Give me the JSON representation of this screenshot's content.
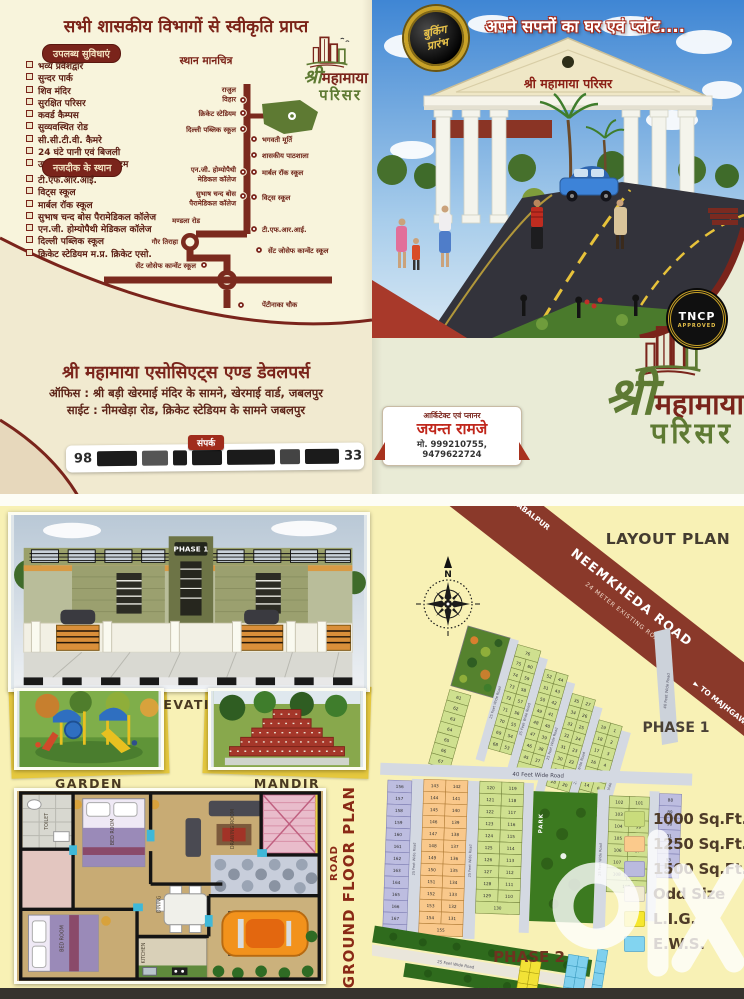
{
  "back": {
    "title": "सभी शासकीय विभागों से स्वीकृति प्राप्त",
    "facilities": {
      "heading": "उपलब्ध सुविधाएं",
      "items": [
        "भव्य प्रवेशद्वार",
        "सुन्दर पार्क",
        "शिव मंदिर",
        "सुरक्षित परिसर",
        "कवर्ड कैम्पस",
        "सुव्यवस्थित रोड",
        "सी.सी.टी.वी. कैमरे",
        "24 घंटे पानी एवं बिजली",
        "उच्च तकनीकी ड्रेनेज सिस्टम"
      ]
    },
    "nearby": {
      "heading": "नजदीक के स्थान",
      "items": [
        "टी.एफ.आर.आई.",
        "विट्स स्कूल",
        "मार्बल रॉक स्कूल",
        "सुभाष चन्द बोस पैरामेडिकल कॉलेज",
        "एन.जी. होम्योपैथी मेडिकल कॉलेज",
        "दिल्ली पब्लिक स्कूल",
        "क्रिकेट स्टेडियम म.प्र. क्रिकेट एसो."
      ]
    },
    "map": {
      "heading": "स्थान मानचित्र",
      "labels": [
        {
          "side": "L",
          "x": 236,
          "y": 16,
          "dot": [
            243,
            24
          ],
          "lines": [
            "राजुल",
            "विहार"
          ]
        },
        {
          "side": "L",
          "x": 236,
          "y": 40,
          "dot": [
            243,
            37
          ],
          "lines": [
            "क्रिकेट स्टेडियम"
          ]
        },
        {
          "side": "L",
          "x": 236,
          "y": 56,
          "dot": [
            243,
            53
          ],
          "lines": [
            "दिल्ली पब्लिक स्कूल"
          ]
        },
        {
          "side": "R",
          "x": 262,
          "y": 66,
          "dot": [
            254,
            63
          ],
          "lines": [
            "भगवती मूर्ति"
          ]
        },
        {
          "side": "R",
          "x": 262,
          "y": 82,
          "dot": [
            254,
            79
          ],
          "lines": [
            "शासकीय पाठशाला"
          ]
        },
        {
          "side": "L",
          "x": 236,
          "y": 96,
          "dot": [
            243,
            96
          ],
          "lines": [
            "एन.जी. होम्योपैथी",
            "मेडिकल कॉलेज"
          ]
        },
        {
          "side": "R",
          "x": 262,
          "y": 99,
          "dot": [
            254,
            96
          ],
          "lines": [
            "मार्बल रॉक स्कूल"
          ]
        },
        {
          "side": "L",
          "x": 236,
          "y": 120,
          "dot": [
            243,
            120
          ],
          "lines": [
            "सुभाष चन्द बोस",
            "पैरामेडिकल कॉलेज"
          ]
        },
        {
          "side": "R",
          "x": 262,
          "y": 124,
          "dot": [
            254,
            121
          ],
          "lines": [
            "विट्स स्कूल"
          ]
        },
        {
          "side": "L",
          "x": 200,
          "y": 147,
          "lines": [
            "मण्डला रोड"
          ]
        },
        {
          "side": "R",
          "x": 262,
          "y": 156,
          "dot": [
            254,
            153
          ],
          "lines": [
            "टी.एफ.आर.आई."
          ]
        },
        {
          "side": "L",
          "x": 178,
          "y": 168,
          "lines": [
            "गौर तिराहा"
          ]
        },
        {
          "side": "R",
          "x": 268,
          "y": 177,
          "dot": [
            259,
            174
          ],
          "lines": [
            "सेंट जोसेफ कान्वेंट स्कूल"
          ]
        },
        {
          "side": "L",
          "x": 196,
          "y": 192,
          "dot": [
            204,
            189
          ],
          "lines": [
            "सेंट जोसेफ कान्वेंट स्कूल"
          ]
        },
        {
          "side": "R",
          "x": 262,
          "y": 231,
          "dot": [
            241,
            229
          ],
          "lines": [
            "पेंटीनाका चौक"
          ]
        }
      ]
    },
    "logo_small": {
      "shree": "श्री",
      "name": "महामाया",
      "sub": "परिसर"
    },
    "company": {
      "name": "श्री महामाया एसोसिएट्स एण्ड डेवलपर्स",
      "office": "ऑफिस : श्री बड़ी खेरमाई मंदिर के सामने, खेरमाई वार्ड, जबलपुर",
      "site": "साईट : नीमखेड़ा रोड, क्रिकेट स्टेडियम के सामने जबलपुर",
      "contact_label": "संपर्क",
      "phone_left": "98",
      "phone_right": "33"
    }
  },
  "front": {
    "headline": "अपने सपनों का घर एवं प्लॉट....",
    "badge": [
      "बुकिंग",
      "प्रारंभ"
    ],
    "gate_sign": "श्री महामाया परिसर",
    "tncp": [
      "TNCP",
      "APPROVED"
    ],
    "logo": {
      "shree": "श्री",
      "name": "महामाया",
      "sub": "परिसर"
    },
    "architect": {
      "role": "आर्किटेक्ट एवं प्लानर",
      "name": "जयन्त रामजे",
      "phone": "मो. 999210755, 9479622724"
    }
  },
  "inside": {
    "phase_sign": "PHASE 1",
    "elevation_label": "ELEVATION",
    "garden_label": "GARDEN",
    "mandir_label": "MANDIR",
    "plan": {
      "road": "ROAD",
      "title": "GROUND FLOOR PLAN"
    },
    "layout": {
      "title": "LAYOUT PLAN",
      "road_name": "NEEMKHEDA ROAD",
      "road_sub": "24 METER EXISTING ROAD",
      "to_left": "◄ TO JABALPUR",
      "to_right": "► TO MAJHGAWAN",
      "phase1": "PHASE 1",
      "phase2": "PHASE 2",
      "park": "PARK",
      "road40": "40 Feet Wide Road",
      "road25": "25 Feet Wide Road",
      "legend": [
        {
          "label": "1000 Sq.Ft.",
          "color": "#c9dc7c"
        },
        {
          "label": "1250 Sq.Ft.",
          "color": "#fbca8c"
        },
        {
          "label": "1500 Sq.Ft.",
          "color": "#babade"
        },
        {
          "label": "Odd Size",
          "color": "#f0ead0"
        },
        {
          "label": "L.I.G.",
          "color": "#f6e72e"
        },
        {
          "label": "E.W.S.",
          "color": "#82d4f0"
        }
      ]
    },
    "watermark": "olx"
  },
  "plat": {
    "colors": {
      "green": "#cfe08f",
      "orange": "#f9c88b",
      "purple": "#bdbde0",
      "yellow": "#f2e236",
      "cyan": "#7fd0ee"
    },
    "phase1": {
      "columns": [
        {
          "x": 0,
          "top": 66,
          "w": 22,
          "cellH": 11,
          "color": "green",
          "single": {
            "from": 61,
            "to": 67
          }
        },
        {
          "x": 53,
          "top": 4,
          "w": 24,
          "cellH": 12,
          "color": "green",
          "head": "76",
          "left": {
            "from": 75,
            "to": 68
          },
          "right": {
            "from": 60,
            "to": 53
          }
        },
        {
          "x": 86,
          "top": 20,
          "w": 24,
          "cellH": 12,
          "color": "green",
          "left": {
            "from": 52,
            "to": 45
          },
          "right": {
            "from": 44,
            "to": 37
          },
          "foot": "36"
        },
        {
          "x": 119,
          "top": 36,
          "w": 24,
          "cellH": 12,
          "color": "green",
          "left": {
            "from": 35,
            "to": 28
          },
          "right": {
            "from": 27,
            "to": 20
          }
        },
        {
          "x": 152,
          "top": 54,
          "w": 24,
          "cellH": 12,
          "color": "green",
          "left": {
            "from": 19,
            "to": 12
          },
          "right": {
            "from": 1,
            "to": 8
          },
          "foot": "9"
        }
      ]
    },
    "phase2": {
      "blocks": [
        {
          "x": 0,
          "top": 2,
          "w": 24,
          "cellH": 12,
          "color": "purple",
          "single": {
            "from": 156,
            "to": 168
          }
        },
        {
          "x": 36,
          "top": 0,
          "w": 44,
          "cellH": 12,
          "color": "orange",
          "left": {
            "from": 143,
            "to": 154
          },
          "right": {
            "from": 142,
            "to": 131
          },
          "foot": "155"
        },
        {
          "x": 92,
          "top": 0,
          "w": 44,
          "cellH": 12,
          "color": "green",
          "left": {
            "from": 120,
            "to": 129
          },
          "right": {
            "from": 119,
            "to": 110
          },
          "foot": "130"
        },
        {
          "x": 222,
          "top": 10,
          "w": 40,
          "cellH": 12,
          "color": "green",
          "left": {
            "from": 102,
            "to": 108
          },
          "right": {
            "from": 101,
            "to": 95
          },
          "foot": "109"
        },
        {
          "x": 272,
          "top": 6,
          "w": 22,
          "cellH": 12,
          "color": "purple",
          "single": {
            "from": 88,
            "to": 94
          }
        }
      ],
      "grids": [
        {
          "x": 150,
          "y": 10,
          "cols": 2,
          "rows": 5,
          "w": 10,
          "h": 12,
          "color": "yellow"
        },
        {
          "x": 122,
          "y": 44,
          "cols": 3,
          "rows": 2,
          "w": 11,
          "h": 10,
          "color": "yellow"
        },
        {
          "x": 196,
          "y": -2,
          "cols": 2,
          "rows": 6,
          "w": 10,
          "h": 11,
          "color": "cyan"
        },
        {
          "x": 224,
          "y": -12,
          "cols": 1,
          "rows": 4,
          "w": 10,
          "h": 12,
          "color": "cyan"
        }
      ]
    }
  }
}
